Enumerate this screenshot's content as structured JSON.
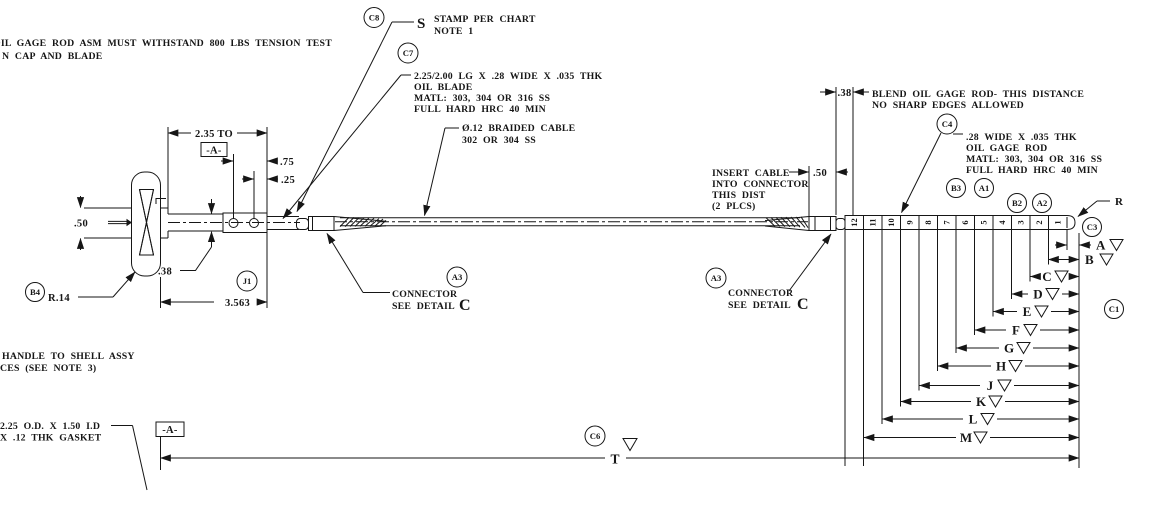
{
  "drawing": {
    "type": "engineering-drawing",
    "subject": "oil gage rod assembly",
    "line_color": "#161616",
    "background": "#ffffff"
  },
  "notes": {
    "tension": {
      "line1": "OIL GAGE ROD ASM MUST WITHSTAND 800 LBS TENSION TEST",
      "line2": "N CAP AND BLADE"
    },
    "stamp": {
      "s": "S",
      "line1": "STAMP PER CHART",
      "line2": "NOTE 1"
    },
    "oil_blade": {
      "line1": "2.25/2.00 LG X .28 WIDE X .035 THK",
      "line2": "OIL BLADE",
      "line3": "MATL: 303, 304 OR 316 SS",
      "line4": "FULL HARD HRC 40 MIN"
    },
    "braided_cable": {
      "line1": "Ø.12 BRAIDED CABLE",
      "line2": "302 OR 304 SS"
    },
    "insert_cable": {
      "line1": "INSERT CABLE",
      "line2": "INTO CONNECTOR",
      "line3": "THIS DIST",
      "line4": "(2 PLCS)"
    },
    "blend": {
      "line1": "BLEND OIL GAGE ROD- THIS DISTANCE",
      "line2": "NO SHARP EDGES ALLOWED"
    },
    "oil_gage_rod": {
      "line1": ".28 WIDE X .035 THK",
      "line2": "OIL GAGE ROD",
      "line3": "MATL: 303, 304 OR 316 SS",
      "line4": "FULL HARD HRC 40 MIN"
    },
    "handle": {
      "line1": "HANDLE TO SHELL ASSY",
      "line2": "CES (SEE NOTE 3)"
    },
    "gasket": {
      "line1": "2.25 O.D. X 1.50 I.D",
      "line2": "X .12 THK GASKET"
    },
    "connector_left": {
      "line1": "CONNECTOR",
      "line2": "SEE DETAIL",
      "detail": "C"
    },
    "connector_right": {
      "line1": "CONNECTOR",
      "line2": "SEE DETAIL",
      "detail": "C"
    }
  },
  "dimensions": {
    "d235": "2.35 TO",
    "datum_a": "-A-",
    "d75": ".75",
    "d25": ".25",
    "d50_left": ".50",
    "d38_left": ".38",
    "d3563": "3.563",
    "r14": "R.14",
    "d50_right": ".50",
    "d38_right": ".38",
    "t": "T",
    "r": "R"
  },
  "balloons": {
    "c8": "C8",
    "c7": "C7",
    "b4": "B4",
    "j1": "J1",
    "a3_left": "A3",
    "a3_right": "A3",
    "c4": "C4",
    "b3": "B3",
    "a1": "A1",
    "b2": "B2",
    "a2": "A2",
    "c3": "C3",
    "c1": "C1",
    "c6": "C6"
  },
  "rod": {
    "numbers": [
      "12",
      "11",
      "10",
      "9",
      "8",
      "7",
      "6",
      "5",
      "4",
      "3",
      "2",
      "1"
    ]
  },
  "scale": {
    "letters": [
      "A",
      "B",
      "C",
      "D",
      "E",
      "F",
      "G",
      "H",
      "J",
      "K",
      "L",
      "M"
    ]
  }
}
